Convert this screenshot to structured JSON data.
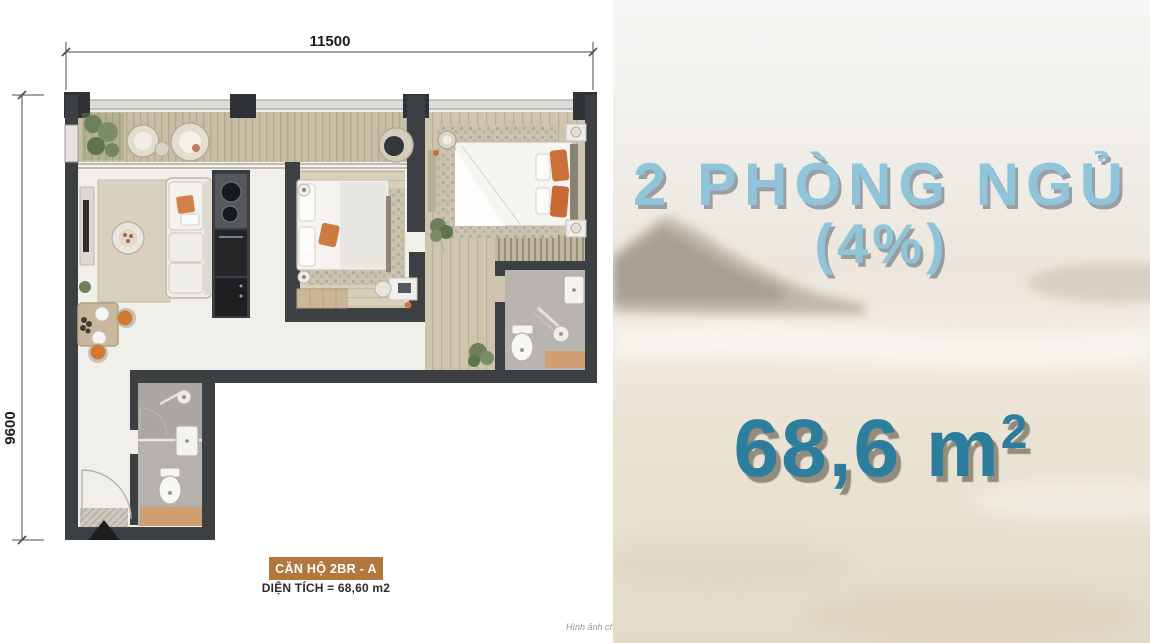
{
  "floor_plan": {
    "dim_width": "11500",
    "dim_height": "9600",
    "unit_label": "CĂN HỘ 2BR - A",
    "area_label": "DIỆN TÍCH = 68,60 m2",
    "footnote": "Hình ảnh ch",
    "colors": {
      "label_bg": "#b1773c",
      "wall": "#3d4043",
      "deck": "#c8bda5",
      "accent_mat": "#cf9e71"
    }
  },
  "promo": {
    "title": "2 PHÒNG NGỦ",
    "subtitle": "(4%)",
    "area_value": "68,6 m",
    "area_sup": "2",
    "title_color": "#90c4d9",
    "area_color": "#2c7d9e"
  }
}
